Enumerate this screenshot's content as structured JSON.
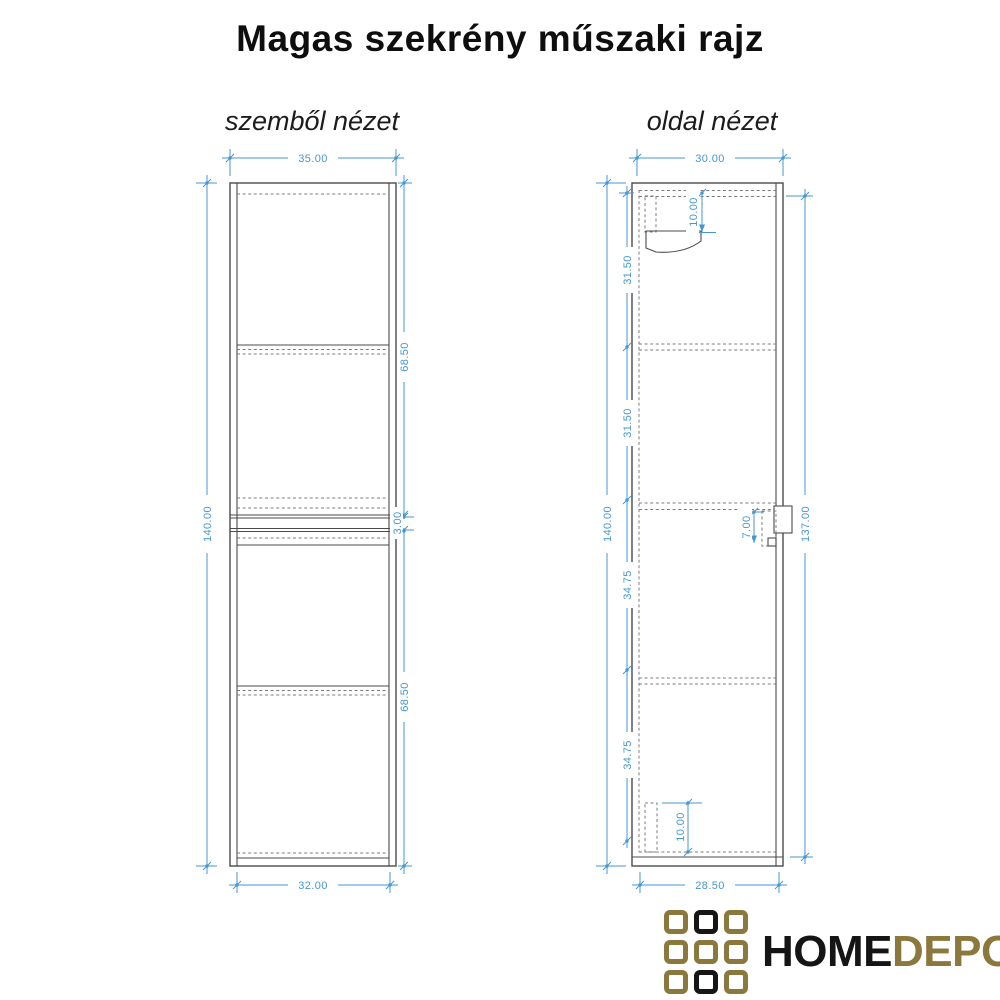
{
  "page": {
    "title": "Magas szekrény műszaki rajz"
  },
  "views": {
    "front": {
      "label": "szemből nézet",
      "dimensions": {
        "overall_width": "35.00",
        "inner_width": "32.00",
        "overall_height": "140.00",
        "upper_module_height": "68.50",
        "module_gap": "3.00",
        "lower_module_height": "68.50"
      }
    },
    "side": {
      "label": "oldal nézet",
      "dimensions": {
        "overall_depth": "30.00",
        "inner_depth": "28.50",
        "overall_height": "140.00",
        "right_height": "137.00",
        "segment_1": "31.50",
        "segment_2": "31.50",
        "segment_3": "34.75",
        "segment_4": "34.75",
        "top_bracket_offset": "10.00",
        "mid_bracket_height": "7.00",
        "bottom_bracket_height": "10.00"
      }
    }
  },
  "logo": {
    "word_primary": "HOME",
    "word_secondary": "DEPO",
    "gold_color": "#8a783c",
    "black_color": "#161616"
  },
  "colors": {
    "dimension_blue": "#4797cf",
    "drawing_line": "#4b4b4b"
  }
}
